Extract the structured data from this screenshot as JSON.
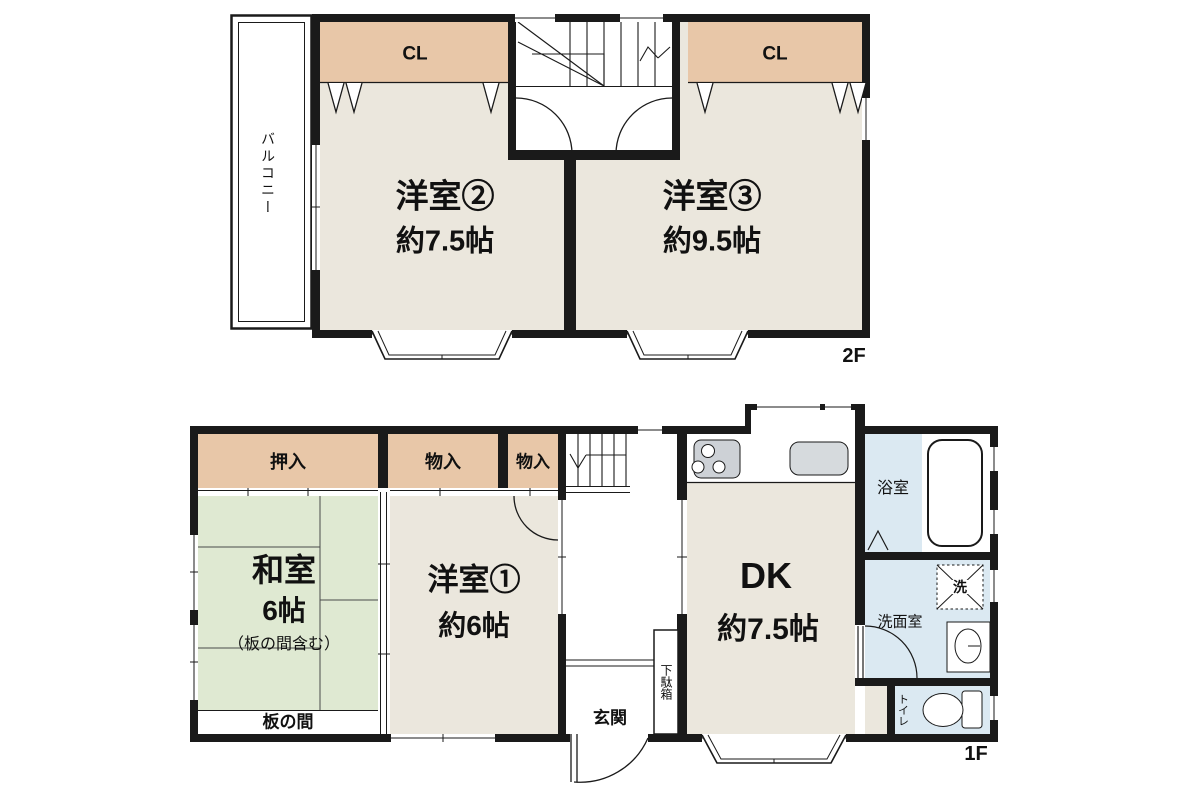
{
  "colors": {
    "wall": "#1a1a1a",
    "western_room_floor": "#ebe7dd",
    "closet": "#e8c7a8",
    "tatami": "#dfe9d2",
    "wet_area": "#dbe9f2",
    "fixture_gray": "#cdd1d6"
  },
  "floor2": {
    "floor_label": "2F",
    "balcony": "バルコニー",
    "closet_left": "CL",
    "closet_right": "CL",
    "room2_name": "洋室②",
    "room2_size": "約7.5帖",
    "room3_name": "洋室③",
    "room3_size": "約9.5帖"
  },
  "floor1": {
    "floor_label": "1F",
    "oshiire": "押入",
    "monoire_1": "物入",
    "monoire_2": "物入",
    "washitsu_name": "和室",
    "washitsu_size": "6帖",
    "washitsu_note": "（板の間含む）",
    "itanoma": "板の間",
    "room1_name": "洋室①",
    "room1_size": "約6帖",
    "genkan": "玄関",
    "getabako": "下駄箱",
    "dk_name": "DK",
    "dk_size": "約7.5帖",
    "bath": "浴室",
    "washroom": "洗面室",
    "laundry": "洗",
    "toilet": "トイレ"
  }
}
